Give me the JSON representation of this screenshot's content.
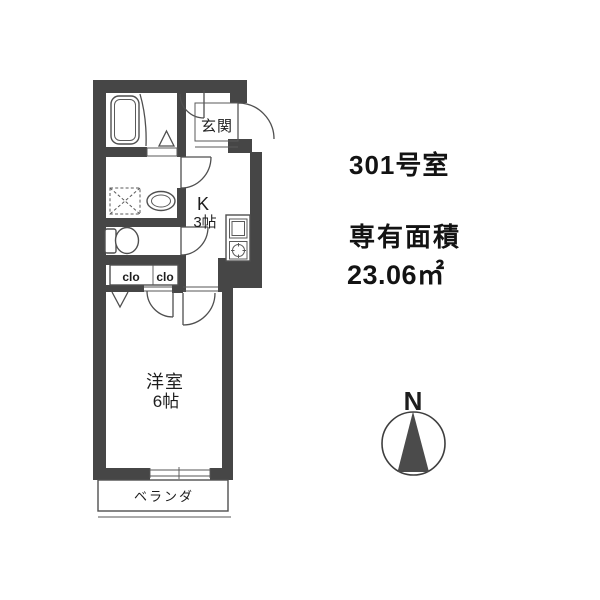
{
  "unit_info": {
    "room_number": "301号室",
    "area_label": "専有面積",
    "area_value": "23.06㎡"
  },
  "floor_plan": {
    "labels": {
      "entrance": "玄関",
      "kitchen": "K",
      "kitchen_size": "3帖",
      "bedroom": "洋室",
      "bedroom_size": "6帖",
      "closet_left": "clo",
      "closet_right": "clo",
      "balcony": "ベランダ"
    }
  },
  "compass": {
    "north": "N"
  },
  "colors": {
    "wall": "#464646",
    "line": "#4f4f4f",
    "needle": "#4b4b4b",
    "text": "#131313"
  }
}
